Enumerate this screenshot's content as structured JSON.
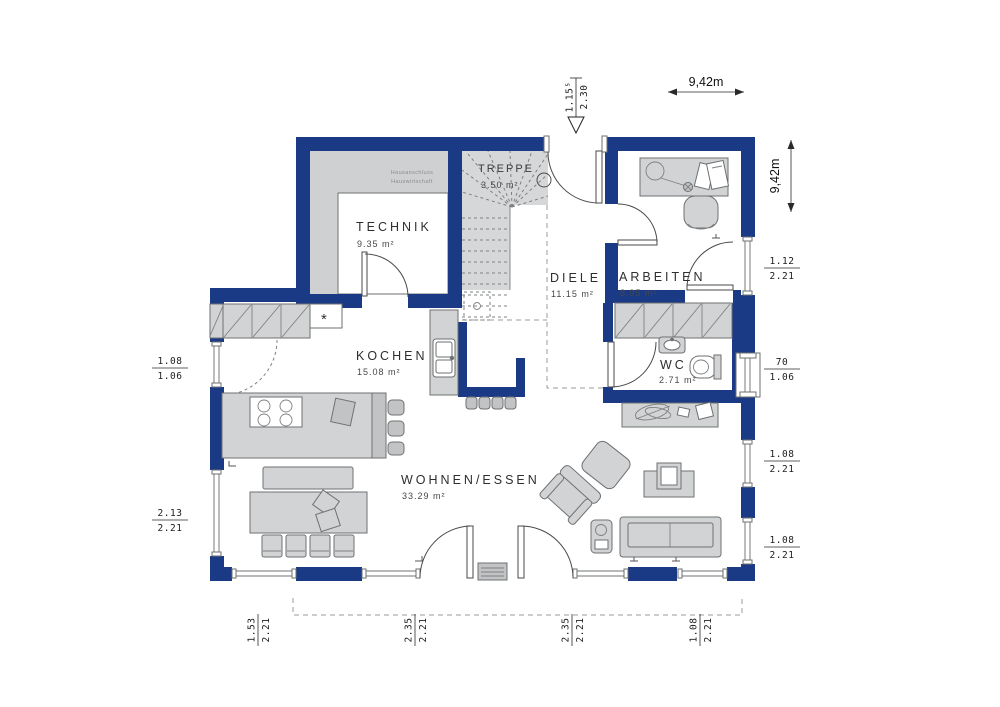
{
  "colors": {
    "wall": "#1b3a85",
    "furniture": "#d2d3d5",
    "outline": "#6e7072",
    "background": "#ffffff"
  },
  "rooms": {
    "technik": {
      "name": "TECHNIK",
      "area": "9.35 m²"
    },
    "treppe": {
      "name": "TREPPE",
      "area": "3.50 m²"
    },
    "diele": {
      "name": "DIELE",
      "area": "11.15 m²"
    },
    "arbeiten": {
      "name": "ARBEITEN",
      "area": "8.95 m²"
    },
    "kochen": {
      "name": "KOCHEN",
      "area": "15.08 m²"
    },
    "wc": {
      "name": "WC",
      "area": "2.71 m²"
    },
    "wohnen": {
      "name": "WOHNEN/ESSEN",
      "area": "33.29 m²"
    }
  },
  "technik_note": {
    "line1": "Hausanschluss",
    "line2": "Hauswirtschaft"
  },
  "symbols": {
    "freezer_star": "*"
  },
  "dimensions": {
    "overall_top": "9,42m",
    "overall_right": "9,42m",
    "entrance": {
      "num": "1.15⁵",
      "den": "2.30"
    },
    "left": [
      {
        "num": "1.08",
        "den": "1.06"
      },
      {
        "num": "2.13",
        "den": "2.21"
      }
    ],
    "right": [
      {
        "num": "1.12",
        "den": "2.21"
      },
      {
        "num": "70",
        "den": "1.06"
      },
      {
        "num": "1.08",
        "den": "2.21"
      },
      {
        "num": "1.08",
        "den": "2.21"
      }
    ],
    "bottom": [
      {
        "num": "1.53",
        "den": "2.21"
      },
      {
        "num": "2.35",
        "den": "2.21"
      },
      {
        "num": "2.35",
        "den": "2.21"
      },
      {
        "num": "1.08",
        "den": "2.21"
      }
    ]
  }
}
